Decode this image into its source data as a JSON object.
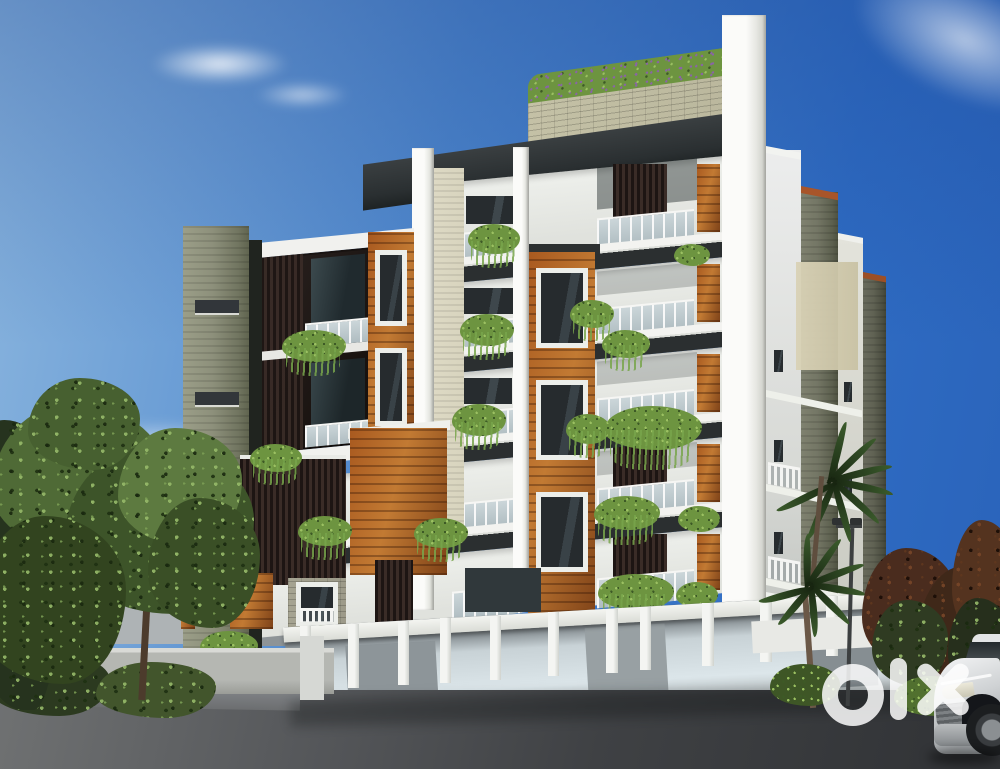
{
  "watermark": {
    "brand": "olx"
  },
  "palette": {
    "sky-right": "#2f6cc3",
    "sky-mid": "#4f88cd",
    "sky-left": "#8ab5de",
    "horizon": "#d8e4ee",
    "white": "#f2f2ef",
    "white-shade": "#dcdeda",
    "soffit": "#2b2f30",
    "fascia": "#2a2f31",
    "olive": "#8d907b",
    "olive-dark": "#5d6353",
    "olive-wall": "#747a68",
    "beige": "#d6cfb4",
    "beige-panel": "#d8d4be",
    "wood": "#a8591f",
    "wood-light": "#c27a33",
    "wood-dark": "#7e4218",
    "slat": "#3a2c27",
    "slat-dark": "#1d1513",
    "glass": "#c2ccd0",
    "glass-dark": "#9fadb2",
    "win": "#272c2f",
    "plant-l": "#9cc162",
    "plant-m": "#6d9440",
    "plant-d": "#3d5a26",
    "flower": "#8a63a8",
    "brick": "#b9b69c",
    "road": "#45474a",
    "road-dark": "#323437",
    "road-light": "#77797a",
    "ground": "#a7a9a8",
    "tree-m": "#4a6332",
    "tree-d": "#2c3d1f",
    "tree-l": "#6c8a47",
    "palm": "#2a4220",
    "maroon": "#4a2c1e",
    "maroon-d": "#35200f",
    "car": "#d4d7d9",
    "car-dark": "#2e3336",
    "lamp": "#3c3f40",
    "wm": "#ffffff"
  }
}
